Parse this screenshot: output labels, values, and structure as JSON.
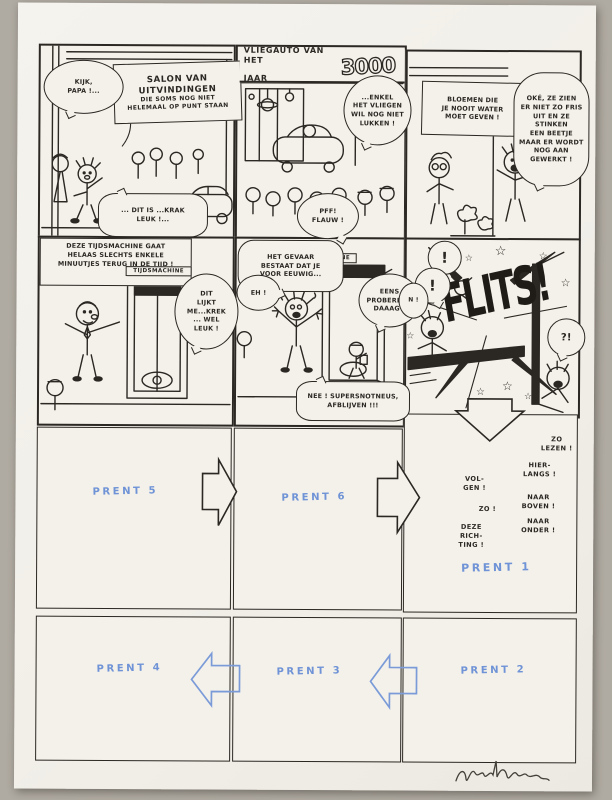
{
  "colors": {
    "ink": "#2b2723",
    "paper": "#f3f1ea",
    "blue_pencil": "#6f93d6",
    "backdrop": "#b0aba2"
  },
  "p1": {
    "kijk": "KIJK,\nPAPA !...",
    "sign1": "SALON VAN",
    "sign2": "UITVINDINGEN",
    "sign3": "DIE SOMS NOG NIET",
    "sign4": "HELEMAAL OP PUNT STAAN",
    "krak": "... DIT IS ...KRAK\nLEUK !..."
  },
  "p2": {
    "sign_line": "VLIEGAUTO VAN HET",
    "jaar": "JAAR",
    "year": "3000",
    "enkel": "...ENKEL\nHET VLIEGEN\nWIL NOG NIET\nLUKKEN !",
    "pff": "PFF!\nFLAUW !"
  },
  "p3": {
    "sign": "BLOEMEN DIE\nJE NOOIT WATER\nMOET GEVEN !",
    "oke": "OKÉ, ZE ZIEN\nER NIET ZO FRIS\nUIT EN ZE STINKEN\nEEN BEETJE\nMAAR ER WORDT\nNOG AAN\nGEWERKT !"
  },
  "p4": {
    "caption": "DEZE TIJDSMACHINE GAAT\nHELAAS SLECHTS ENKELE\nMINUUTJES TERUG IN DE TIJD !",
    "label": "TIJDSMACHINE",
    "dit": "DIT\nLIJKT\nME...KREK\n... WEL\nLEUK !"
  },
  "p5": {
    "gevaar": "HET GEVAAR\nBESTAAT DAT JE\nVOOR EEUWIG...",
    "label": "TIJDSMACHINE",
    "eh": "EH !",
    "eens": "EENS\nPROBEREN !\nDAAAG !",
    "nee": "NEE ! SUPERSNOTNEUS,\nAFBLIJVEN !!!"
  },
  "p6": {
    "flits": "FLITS!",
    "excl": "!",
    "edge": "N !",
    "interro": "?!"
  },
  "nav": {
    "zo_lezen": "ZO\nLEZEN !",
    "hier_langs": "HIER-\nLANGS !",
    "vol_gen": "VOL-\nGEN !",
    "naar_boven": "NAAR\nBOVEN !",
    "zo": "ZO !",
    "naar_onder": "NAAR\nONDER !",
    "deze_richting": "DEZE\nRICH-\nTING !"
  },
  "prent": {
    "p1": "PRENT 1",
    "p2": "PRENT 2",
    "p3": "PRENT 3",
    "p4": "PRENT 4",
    "p5": "PRENT 5",
    "p6": "PRENT 6"
  },
  "decor": {
    "star": "☆"
  }
}
